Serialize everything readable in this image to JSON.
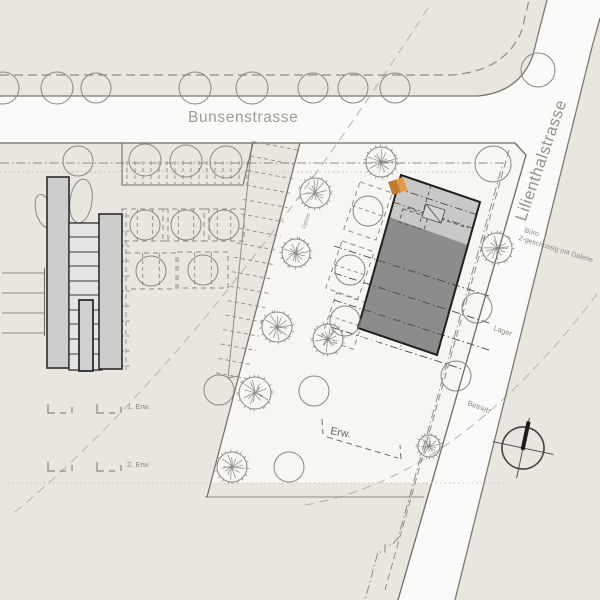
{
  "labels": {
    "bunsenstrasse": "Bunsenstrasse",
    "lilienthalstrasse": "Lilienthalstrasse",
    "buero_line1": "Büro",
    "buero_line2": "2-geschossig mit Galerie",
    "lager": "Lager",
    "betrieb": "Betrieb",
    "ba": "1. BA",
    "erw": "Erw.",
    "erw1": "1. Erw.",
    "erw2": "2. Erw.",
    "option": "Option"
  },
  "colors": {
    "paper": "#e9e6e0",
    "street_white": "#fafaf8",
    "parcel_white": "#f7f6f3",
    "building_dark": "#8c8c8a",
    "building_light": "#c9c8c6",
    "building_outline": "#1f1f1d",
    "complex_fill": "#cdcdcb",
    "hall_fill": "#e5e4e2",
    "accent_orange": "#e09a4a",
    "accent_orange_dark": "#c27c2e",
    "line_dark": "#6e6b63",
    "line_mid": "#8f8c84",
    "line_light": "#b5b2a8",
    "tree_stroke": "#8a8781",
    "text_gray": "#9b978e",
    "text_dark": "#5f5d57",
    "ba_text": "#efeeea"
  },
  "plan": {
    "trees_plain": [
      [
        3,
        88,
        16
      ],
      [
        57,
        88,
        16
      ],
      [
        96,
        88,
        15
      ],
      [
        195,
        88,
        16
      ],
      [
        252,
        88,
        16
      ],
      [
        313,
        88,
        15
      ],
      [
        353,
        88,
        15
      ],
      [
        395,
        88,
        15
      ],
      [
        538,
        70,
        17
      ],
      [
        145,
        160,
        16
      ],
      [
        186,
        161,
        16
      ],
      [
        226,
        162,
        16
      ],
      [
        145,
        225,
        15
      ],
      [
        186,
        225,
        15
      ],
      [
        224,
        225,
        15
      ],
      [
        151,
        271,
        15
      ],
      [
        203,
        270,
        15
      ],
      [
        368,
        211,
        15
      ],
      [
        350,
        270,
        15
      ],
      [
        345,
        321,
        15
      ],
      [
        219,
        390,
        15
      ],
      [
        314,
        391,
        15
      ],
      [
        289,
        467,
        15
      ],
      [
        493,
        164,
        18
      ],
      [
        477,
        308,
        15
      ],
      [
        456,
        376,
        15
      ],
      [
        78,
        161,
        15
      ]
    ],
    "trees_branchy": [
      [
        381,
        162,
        15
      ],
      [
        315,
        193,
        15
      ],
      [
        296,
        253,
        14
      ],
      [
        277,
        327,
        15
      ],
      [
        328,
        339,
        15
      ],
      [
        255,
        393,
        16
      ],
      [
        232,
        467,
        15
      ],
      [
        429,
        446,
        11
      ],
      [
        497,
        248,
        15
      ]
    ],
    "stall_groups": [
      [
        145,
        225,
        46,
        32
      ],
      [
        186,
        225,
        46,
        32
      ],
      [
        224,
        225,
        40,
        32
      ],
      [
        151,
        271,
        50,
        36
      ],
      [
        203,
        270,
        50,
        36
      ]
    ],
    "rot_stall_groups": [
      [
        368,
        211,
        34,
        50,
        19
      ],
      [
        350,
        270,
        34,
        50,
        19
      ],
      [
        345,
        321,
        34,
        48,
        19
      ]
    ],
    "axis_lines": [
      [
        396,
        188,
        478,
        215
      ],
      [
        393,
        202,
        472,
        228
      ],
      [
        334,
        246,
        492,
        297
      ],
      [
        334,
        273,
        492,
        324
      ],
      [
        334,
        300,
        492,
        351
      ],
      [
        331,
        327,
        462,
        369
      ]
    ],
    "hall_lines": [
      237,
      252,
      266,
      281,
      295,
      310,
      324,
      339,
      354
    ],
    "edge_ticks": [
      273,
      293,
      313,
      333
    ],
    "band": {
      "x1": 276,
      "y1": 146,
      "x2": 233,
      "y2": 376,
      "count": 16,
      "len_top": 24,
      "len_bottom": 17
    },
    "trap_ticks": {
      "x_start": 127,
      "x_end": 247,
      "step": 8,
      "y1": 161,
      "y2": 184
    },
    "ladder": {
      "x1": 121,
      "x2": 131,
      "y_start": 216,
      "y_end": 368,
      "step": 15
    },
    "legend_rows": [
      {
        "symbols": [
          [
            48,
            413
          ],
          [
            97,
            413
          ]
        ],
        "label_x": 127,
        "label_y": 409,
        "key": "erw1"
      },
      {
        "symbols": [
          [
            48,
            471
          ],
          [
            97,
            471
          ]
        ],
        "label_x": 127,
        "label_y": 467,
        "key": "erw2"
      }
    ]
  }
}
